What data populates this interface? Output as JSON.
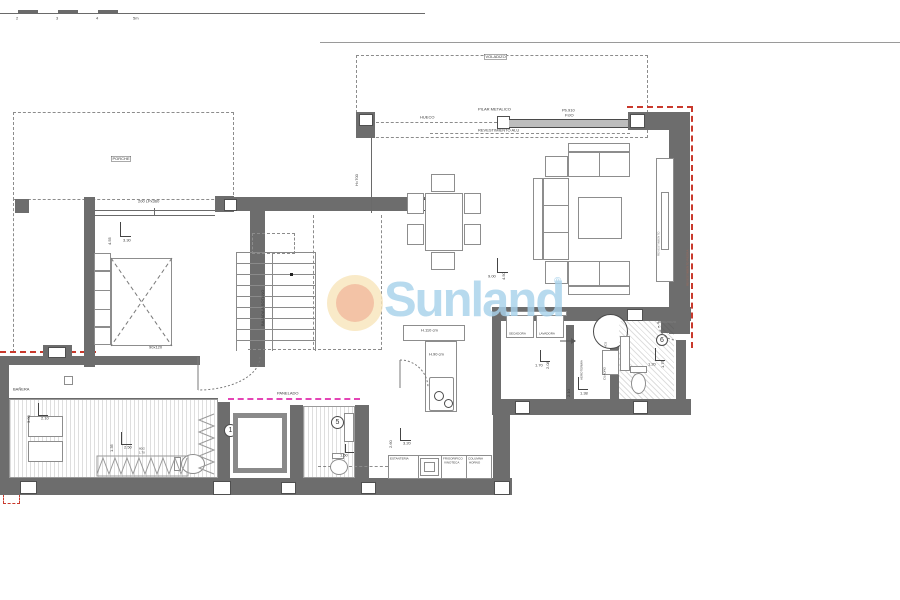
{
  "watermark": {
    "brand": "Sunland",
    "registered_mark": "®"
  },
  "scale_bar": {
    "t2": "2",
    "t3": "3",
    "t4": "4",
    "t5": "5m"
  },
  "rooms": {
    "porche": "PORCHE",
    "voladizo": "VOLADIZO"
  },
  "annotations": {
    "hueco": "HUECO",
    "pilar_metalico": "PILAR METALICO",
    "pb910": "Pb.910",
    "fijo": "FIJO",
    "revestimiento_alu": "REVESTIMIENTO ALU",
    "window_spec": "200 LPx360",
    "glass_height": "H=700",
    "shower_size": "90x120",
    "stairs_note": "BAJADA A SOTANO",
    "panelado": "PANELADO",
    "banera": "BAÑERA",
    "secadora": "SECADORA",
    "lavadora": "LAVADORA",
    "aerotermia": "AEROTERMIA",
    "acs": "ACS",
    "cuadro": "CUADRO",
    "island_high": "H.110 cm",
    "island_low": "H.90 cm",
    "estanteria": "ESTANTERIA",
    "frigorifico": "FRIGORIFICO",
    "vinoteca": "VINOTECA",
    "columna": "COLUMNA",
    "horno": "HORNO",
    "mueble_pared": "REVESTIMIENTO",
    "muro_exterior": "REVESTIMIENTO PIEDRA",
    "step_note_1": "60/2",
    "step_note_2": "1.70"
  },
  "dimensions": {
    "bedroom_v": "4.55",
    "bedroom_h": "3.30",
    "living_v": "4.50",
    "living_h": "9.00",
    "kitchen_v": "2.60",
    "kitchen_h": "3.20",
    "laundry_v": "2.08",
    "laundry_h": "1.70",
    "utility_v": "2.10",
    "utility_h": "1.38",
    "bath_right_v": "1.75",
    "bath_right_h": "1.20",
    "bath_small_h": "1.50",
    "hall_v": "1.35",
    "hall_h": "2.50",
    "bath_master_v": "3.00",
    "bath_master_h": "2.10"
  },
  "door_tags": {
    "bath_master": "1",
    "bath_small": "5",
    "bath_right": "6"
  },
  "colors": {
    "wall": "#6d6d6d",
    "line": "#555555",
    "red_dash": "#c9392c",
    "magenta_dash": "#e445b5",
    "brand_blue": "#a8d2eb",
    "logo_inner": "#f1b793",
    "logo_outer": "#f8e6bc"
  }
}
